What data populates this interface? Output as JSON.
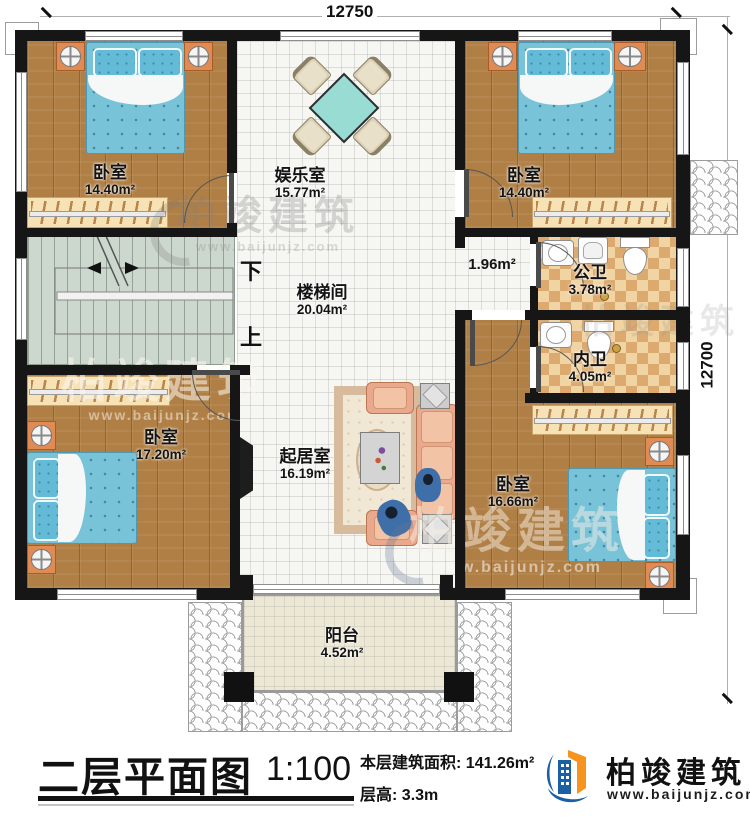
{
  "plan": {
    "dimensions": {
      "top": "12750",
      "right": "12700"
    },
    "rooms": [
      {
        "name": "卧室",
        "area": "14.40m²"
      },
      {
        "name": "娱乐室",
        "area": "15.77m²"
      },
      {
        "name": "卧室",
        "area": "14.40m²"
      },
      {
        "name": "楼梯间",
        "area": "20.04m²"
      },
      {
        "name": "公卫",
        "area": "3.78m²"
      },
      {
        "name": "内卫",
        "area": "4.05m²"
      },
      {
        "name": "卧室",
        "area": "17.20m²"
      },
      {
        "name": "起居室",
        "area": "16.19m²"
      },
      {
        "name": "卧室",
        "area": "16.66m²"
      },
      {
        "name": "阳台",
        "area": "4.52m²"
      }
    ],
    "annotations": {
      "corridor_area": "1.96m²",
      "stair_down": "下",
      "stair_up": "上"
    }
  },
  "titlebar": {
    "title": "二层平面图",
    "scale": "1:100",
    "floor_area_label": "本层建筑面积:",
    "floor_area_value": "141.26m²",
    "floor_height_label": "层高:",
    "floor_height_value": "3.3m"
  },
  "brand": {
    "name": "柏竣建筑",
    "website": "www.baijunjz.com",
    "blue": "#1b5fa5",
    "orange": "#f7941e"
  },
  "watermark": {
    "name": "柏竣建筑",
    "website": "www.baijunjz.com"
  }
}
